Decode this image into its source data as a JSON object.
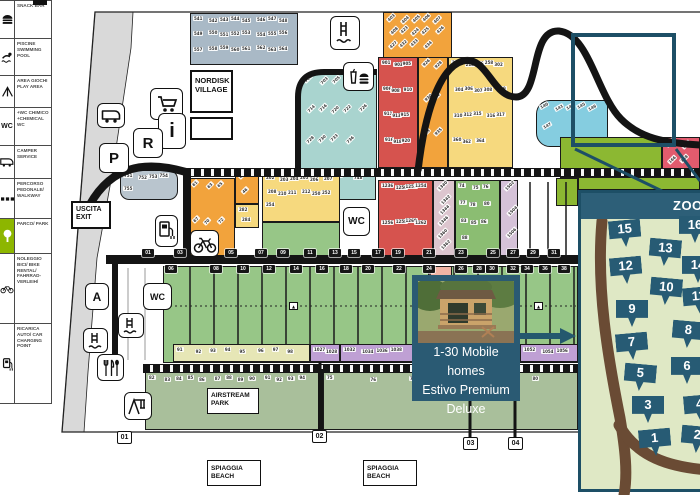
{
  "colors": {
    "accent_dark_blue": "#1d4f66",
    "panel_blue": "#2a5a73",
    "badge_blue": "#275b74",
    "road_black": "#141414",
    "inset_bg": "#dfe8c5",
    "inset_road_brown": "#6a4b34",
    "park_green": "#8db600"
  },
  "legend": {
    "rows": [
      {
        "icon": "snack-bar-icon",
        "text": "SNACK BAR",
        "h": 38
      },
      {
        "icon": "swimming-pool-icon",
        "text": "PISCINE SWIMMING POOL",
        "h": 37
      },
      {
        "icon": "play-area-icon",
        "text": "AREA GIOCHI PLAY AREA",
        "h": 32
      },
      {
        "icon": "chemical-wc-icon",
        "text": "+WC CHIMICO +CHEMICAL WC",
        "h": 38
      },
      {
        "icon": "camper-service-icon",
        "text": "CAMPER SERVICE",
        "h": 33
      },
      {
        "icon": "walkway-icon",
        "text": "PERCORSO PEDONALE/ WALKWAY",
        "h": 40
      },
      {
        "icon": "park-icon",
        "text": "PARCO/ PARK",
        "h": 35,
        "highlight": true
      },
      {
        "icon": "bike-rental-icon",
        "text": "NOLEGGIO BICI/ BIKE RENTAL/ FAHRRAD- VERLEIH/",
        "h": 70
      },
      {
        "icon": "car-charging-icon",
        "text": "RICARICA AUTO/ CAR CHARGING POINT",
        "h": 79
      }
    ]
  },
  "map": {
    "labels": {
      "nordisk_village": "NORDISK VILLAGE",
      "uscita": "USCITA EXIT",
      "airstream": "AIRSTREAM PARK",
      "beach1": "SPIAGGIA BEACH",
      "beach2": "SPIAGGIA BEACH",
      "wc": "WC",
      "parking": "P",
      "reception": "R",
      "info": "i",
      "area_a": "A"
    },
    "info_card": {
      "lines": [
        "1-30 Mobile homes",
        "Estivo Premium",
        "Deluxe"
      ]
    },
    "exit_markers": [
      {
        "label": "01",
        "x": 117,
        "y": 431
      },
      {
        "label": "02",
        "x": 312,
        "y": 430
      },
      {
        "label": "03",
        "x": 463,
        "y": 437
      },
      {
        "label": "04",
        "x": 508,
        "y": 437
      }
    ],
    "pitch_rows": {
      "odd": {
        "y": 249,
        "tags": [
          [
            "01",
            142
          ],
          [
            "03",
            174
          ],
          [
            "05",
            225
          ],
          [
            "07",
            255
          ],
          [
            "09",
            277
          ],
          [
            "11",
            304
          ],
          [
            "13",
            329
          ],
          [
            "15",
            348
          ],
          [
            "17",
            372
          ],
          [
            "19",
            392
          ],
          [
            "21",
            423
          ],
          [
            "23",
            455
          ],
          [
            "25",
            487
          ],
          [
            "27",
            507
          ],
          [
            "29",
            527
          ],
          [
            "31",
            548
          ]
        ]
      },
      "even": {
        "y": 265,
        "tags": [
          [
            "06",
            165
          ],
          [
            "08",
            210
          ],
          [
            "10",
            237
          ],
          [
            "12",
            263
          ],
          [
            "14",
            290
          ],
          [
            "16",
            316
          ],
          [
            "18",
            340
          ],
          [
            "20",
            362
          ],
          [
            "22",
            393
          ],
          [
            "24",
            423
          ],
          [
            "26",
            455
          ],
          [
            "28",
            473
          ],
          [
            "30",
            486
          ],
          [
            "32",
            507
          ],
          [
            "34",
            521
          ],
          [
            "36",
            539
          ],
          [
            "38",
            558
          ]
        ]
      }
    },
    "zones": [
      {
        "name": "slate-top",
        "color": "#a9b9c6",
        "x": 190,
        "y": 13,
        "w": 108,
        "h": 52,
        "rot": 0,
        "tags": [
          "541",
          "542",
          "543",
          "544",
          "545",
          "546",
          "547",
          "548",
          "549",
          "550",
          "551",
          "552",
          "553",
          "554",
          "555",
          "556",
          "557",
          "558",
          "559",
          "560",
          "561",
          "562",
          "563",
          "564"
        ]
      },
      {
        "name": "orange-top",
        "color": "#f2a33c",
        "x": 383,
        "y": 12,
        "w": 69,
        "h": 46,
        "rot": -45,
        "tags": [
          "403",
          "404",
          "405",
          "406",
          "407",
          "408",
          "423",
          "424",
          "425",
          "426",
          "427",
          "432",
          "433",
          "434"
        ]
      },
      {
        "name": "red-upper",
        "color": "#d6534e",
        "x": 378,
        "y": 57,
        "w": 40,
        "h": 111,
        "rot": 0,
        "tags": [
          "901",
          "903",
          "905",
          "906",
          "908",
          "910",
          "911",
          "913",
          "915",
          "916",
          "918",
          "920"
        ]
      },
      {
        "name": "orange-strip",
        "color": "#f2a33c",
        "x": 418,
        "y": 57,
        "w": 30,
        "h": 111,
        "rot": -45,
        "tags": [
          "926",
          "928",
          "930",
          "931",
          "933",
          "935"
        ]
      },
      {
        "name": "yellow-main",
        "color": "#f6d97e",
        "x": 448,
        "y": 57,
        "w": 65,
        "h": 111,
        "rot": 0,
        "tags": [
          "216",
          "218",
          "256",
          "258",
          "302",
          "304",
          "306",
          "307",
          "308",
          "309",
          "310",
          "312",
          "315",
          "316",
          "317",
          "360",
          "362",
          "364"
        ]
      },
      {
        "name": "teal-left",
        "color": "#a9d4cf",
        "x": 300,
        "y": 73,
        "w": 77,
        "h": 97,
        "rot": -45,
        "radius": "18px 0 0 0",
        "tags": [
          "701",
          "703",
          "705",
          "708",
          "712",
          "714",
          "716",
          "720",
          "722",
          "726",
          "728",
          "730",
          "733",
          "736"
        ]
      },
      {
        "name": "teal-tongue",
        "color": "#a9d4cf",
        "x": 330,
        "y": 170,
        "w": 46,
        "h": 30,
        "rot": 0,
        "tags": [
          "746",
          "748"
        ]
      },
      {
        "name": "slate-blob",
        "color": "#b9c5ce",
        "x": 120,
        "y": 170,
        "w": 58,
        "h": 30,
        "rot": 0,
        "radius": "9px",
        "tags": [
          "751",
          "752",
          "753",
          "754",
          "755"
        ]
      },
      {
        "name": "lightblue-right",
        "color": "#85cde0",
        "x": 536,
        "y": 100,
        "w": 72,
        "h": 47,
        "rot": -30,
        "radius": "14px 0 0 14px",
        "tags": [
          "140",
          "141",
          "142",
          "145",
          "146",
          "147"
        ]
      },
      {
        "name": "brightgreen-right",
        "color": "#8cb832",
        "x": 560,
        "y": 137,
        "w": 102,
        "h": 41,
        "rot": 0,
        "tags": []
      },
      {
        "name": "brightgreen-strip",
        "color": "#8cb832",
        "x": 578,
        "y": 177,
        "w": 122,
        "h": 13,
        "rot": 0,
        "tags": []
      },
      {
        "name": "brightgreen-sliver",
        "color": "#8cb832",
        "x": 556,
        "y": 178,
        "w": 22,
        "h": 28,
        "rot": 0,
        "tags": []
      },
      {
        "name": "pink-right",
        "color": "#e25b6e",
        "x": 662,
        "y": 137,
        "w": 38,
        "h": 40,
        "rot": -45,
        "tags": [
          "162",
          "164",
          "166",
          "168"
        ]
      },
      {
        "name": "orange-lower",
        "color": "#f2a33c",
        "x": 188,
        "y": 178,
        "w": 47,
        "h": 80,
        "rot": -45,
        "tags": [
          "61",
          "63",
          "65",
          "67",
          "70",
          "72"
        ]
      },
      {
        "name": "orange-small",
        "color": "#f2a33c",
        "x": 235,
        "y": 170,
        "w": 24,
        "h": 34,
        "rot": -45,
        "tags": [
          "45",
          "46"
        ]
      },
      {
        "name": "yellow-small",
        "color": "#f6d97e",
        "x": 235,
        "y": 204,
        "w": 24,
        "h": 24,
        "rot": 0,
        "tags": [
          "282",
          "284"
        ]
      },
      {
        "name": "yellow-band",
        "color": "#f6d97e",
        "x": 262,
        "y": 172,
        "w": 78,
        "h": 50,
        "rot": 0,
        "tags": [
          "202",
          "203",
          "204",
          "205",
          "206",
          "207",
          "208",
          "210",
          "211",
          "212",
          "250",
          "252",
          "254"
        ]
      },
      {
        "name": "green-upper",
        "color": "#97c687",
        "x": 262,
        "y": 222,
        "w": 78,
        "h": 36,
        "rot": 0,
        "tags": []
      },
      {
        "name": "red-lower",
        "color": "#d6534e",
        "x": 378,
        "y": 180,
        "w": 55,
        "h": 78,
        "rot": 0,
        "tags": [
          "1236",
          "1250",
          "1252",
          "1254",
          "1256",
          "1258",
          "1260",
          "1262"
        ]
      },
      {
        "name": "mauve-strip-1",
        "color": "#dcc5ce",
        "x": 433,
        "y": 180,
        "w": 22,
        "h": 78,
        "rot": -45,
        "tags": [
          "1340",
          "1342",
          "1344",
          "1346",
          "1360",
          "1362"
        ]
      },
      {
        "name": "green-mid",
        "color": "#8bbd72",
        "x": 455,
        "y": 180,
        "w": 45,
        "h": 78,
        "rot": 0,
        "tags": [
          "74",
          "75",
          "76",
          "77",
          "78",
          "80",
          "83",
          "85",
          "86",
          "88"
        ]
      },
      {
        "name": "mauve-strip-2",
        "color": "#d5c2d8",
        "x": 500,
        "y": 180,
        "w": 18,
        "h": 78,
        "rot": -45,
        "tags": [
          "1502",
          "1504",
          "1506"
        ]
      },
      {
        "name": "green-main",
        "color": "#97c687",
        "x": 163,
        "y": 266,
        "w": 415,
        "h": 97,
        "rot": 0,
        "tags": []
      },
      {
        "name": "salmon-block",
        "color": "#f0b4a4",
        "x": 428,
        "y": 266,
        "w": 24,
        "h": 22,
        "rot": 0,
        "tags": []
      },
      {
        "name": "paleyellow-strip",
        "color": "#e6e6b6",
        "x": 173,
        "y": 344,
        "w": 137,
        "h": 18,
        "rot": 0,
        "tags": [
          "91",
          "92",
          "93",
          "94",
          "95",
          "96",
          "97",
          "98"
        ]
      },
      {
        "name": "purple-strip-1",
        "color": "#bfa0d4",
        "x": 310,
        "y": 344,
        "w": 30,
        "h": 18,
        "rot": 0,
        "tags": [
          "1027",
          "1028"
        ]
      },
      {
        "name": "purple-strip-2",
        "color": "#bfa0d4",
        "x": 340,
        "y": 344,
        "w": 73,
        "h": 18,
        "rot": 0,
        "tags": [
          "1032",
          "1034",
          "1036",
          "1038"
        ]
      },
      {
        "name": "purple-strip-3",
        "color": "#bfa0d4",
        "x": 520,
        "y": 344,
        "w": 58,
        "h": 18,
        "rot": 0,
        "tags": [
          "1052",
          "1054",
          "1056"
        ]
      },
      {
        "name": "sage-strip-left",
        "color": "#a9bf9b",
        "x": 145,
        "y": 372,
        "w": 175,
        "h": 58,
        "rot": 0,
        "tags": [
          "82",
          "83",
          "84",
          "85",
          "86",
          "87",
          "88",
          "89",
          "90",
          "91",
          "92",
          "93",
          "94"
        ]
      },
      {
        "name": "sage-strip-right",
        "color": "#a9bf9b",
        "x": 323,
        "y": 372,
        "w": 255,
        "h": 58,
        "rot": 0,
        "tags": [
          "75",
          "76",
          "77",
          "78",
          "79",
          "80"
        ]
      }
    ]
  },
  "inset": {
    "title": "ZOOM",
    "badges": [
      {
        "n": "15",
        "x": 44,
        "y": 40
      },
      {
        "n": "16",
        "x": 114,
        "y": 36
      },
      {
        "n": "13",
        "x": 84,
        "y": 59
      },
      {
        "n": "12",
        "x": 45,
        "y": 77
      },
      {
        "n": "14",
        "x": 117,
        "y": 76
      },
      {
        "n": "10",
        "x": 85,
        "y": 98
      },
      {
        "n": "11",
        "x": 118,
        "y": 107
      },
      {
        "n": "9",
        "x": 51,
        "y": 120
      },
      {
        "n": "8",
        "x": 107,
        "y": 141
      },
      {
        "n": "7",
        "x": 51,
        "y": 153
      },
      {
        "n": "6",
        "x": 106,
        "y": 177
      },
      {
        "n": "5",
        "x": 59,
        "y": 184
      },
      {
        "n": "4",
        "x": 119,
        "y": 215
      },
      {
        "n": "3",
        "x": 67,
        "y": 216
      },
      {
        "n": "2",
        "x": 116,
        "y": 246
      },
      {
        "n": "1",
        "x": 74,
        "y": 249
      }
    ]
  }
}
